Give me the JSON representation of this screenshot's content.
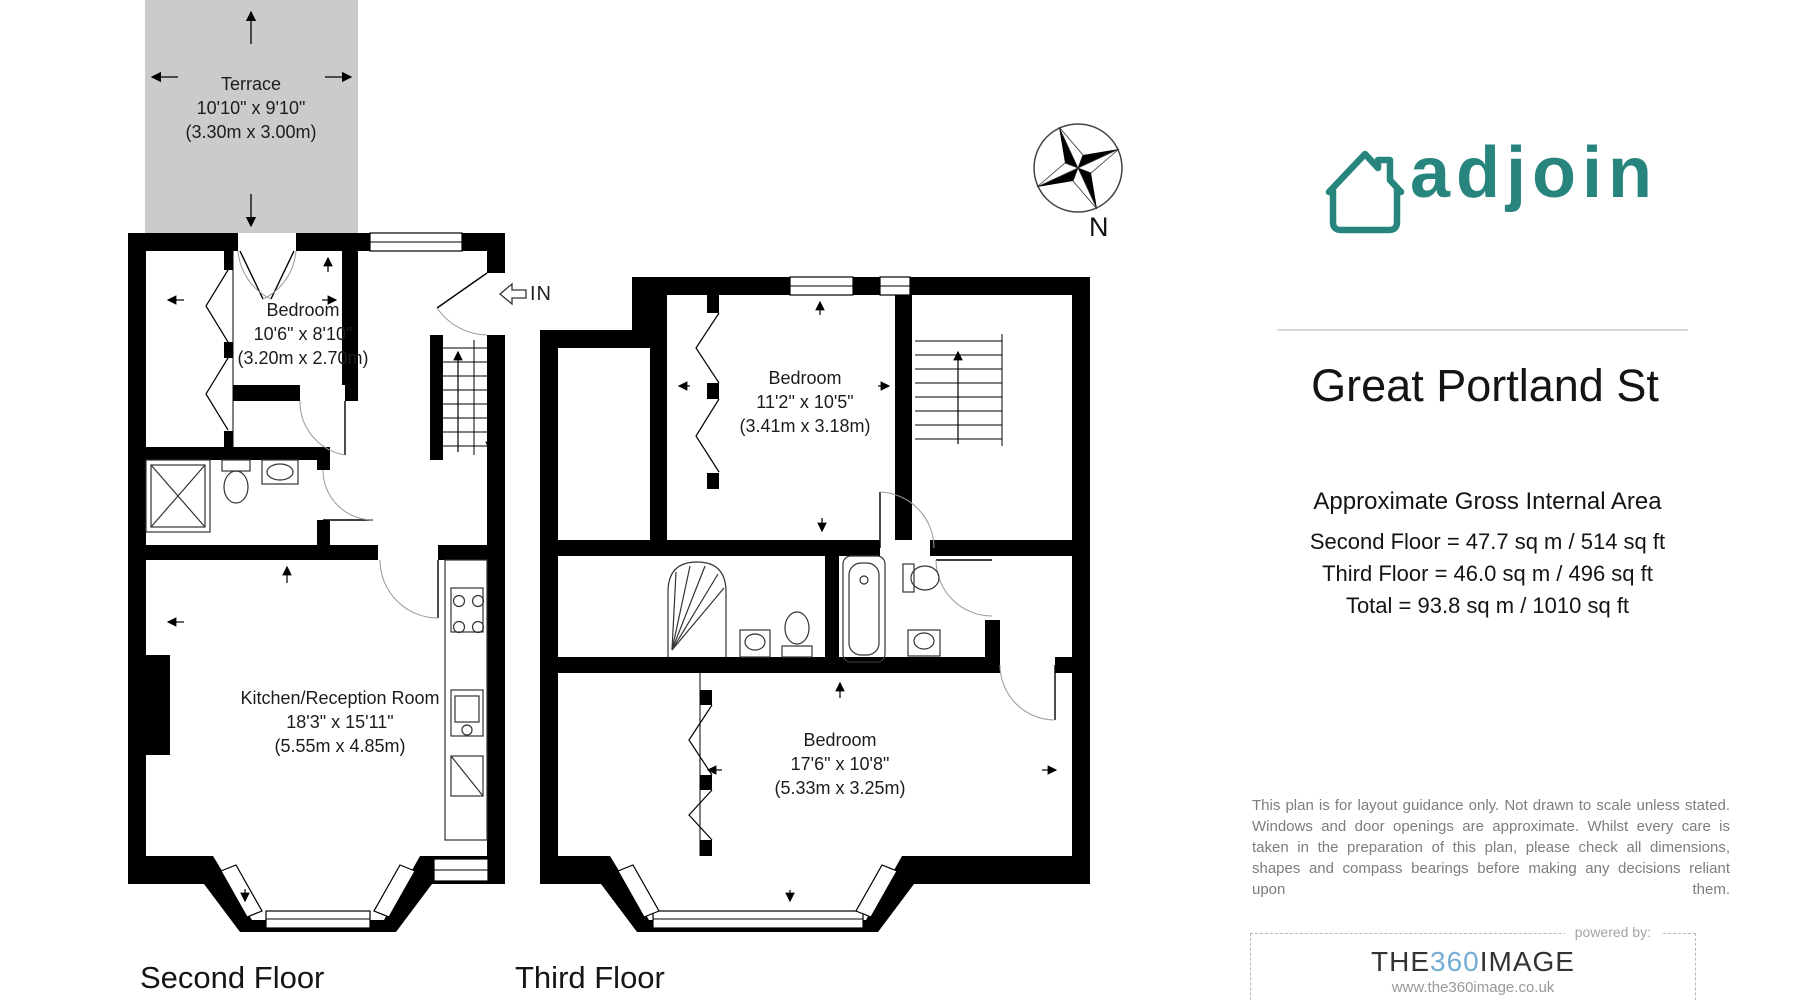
{
  "brand": {
    "logo_text": "adjoin",
    "logo_color": "#27857e",
    "house_icon": "house-outline-icon"
  },
  "compass": {
    "label": "N",
    "icon": "compass-rose-icon"
  },
  "entrance": {
    "label": "IN",
    "icon": "entrance-arrow-left-icon"
  },
  "property": {
    "title": "Great Portland St"
  },
  "area_summary": {
    "heading": "Approximate Gross Internal Area",
    "lines": [
      "Second Floor = 47.7 sq m / 514 sq ft",
      "Third Floor = 46.0 sq m / 496 sq ft",
      "Total = 93.8 sq m / 1010 sq ft"
    ]
  },
  "disclaimer": "This plan is for layout guidance only. Not drawn to scale unless stated. Windows and door openings are approximate. Whilst every care is taken in the preparation of this plan, please check all dimensions, shapes and compass bearings before making any decisions reliant upon them.",
  "footer": {
    "powered_by": "powered by:",
    "brand_the": "THE",
    "brand_360": "360",
    "brand_image": "IMAGE",
    "brand_360_color": "#74add4",
    "url": "www.the360image.co.uk"
  },
  "colors": {
    "terrace_fill": "#cbcbcb",
    "wall": "#000000",
    "accent_teal": "#27857e"
  },
  "floors": {
    "second": {
      "label": "Second Floor",
      "rooms": {
        "terrace": {
          "name": "Terrace",
          "imperial": "10'10\" x 9'10\"",
          "metric": "(3.30m x 3.00m)"
        },
        "bedroom": {
          "name": "Bedroom",
          "imperial": "10'6\" x 8'10\"",
          "metric": "(3.20m x 2.70m)"
        },
        "kitchen": {
          "name": "Kitchen/Reception Room",
          "imperial": "18'3\" x 15'11\"",
          "metric": "(5.55m x 4.85m)"
        }
      }
    },
    "third": {
      "label": "Third Floor",
      "rooms": {
        "bedroom1": {
          "name": "Bedroom",
          "imperial": "11'2\" x 10'5\"",
          "metric": "(3.41m x 3.18m)"
        },
        "bedroom2": {
          "name": "Bedroom",
          "imperial": "17'6\" x 10'8\"",
          "metric": "(5.33m x 3.25m)"
        }
      }
    }
  }
}
